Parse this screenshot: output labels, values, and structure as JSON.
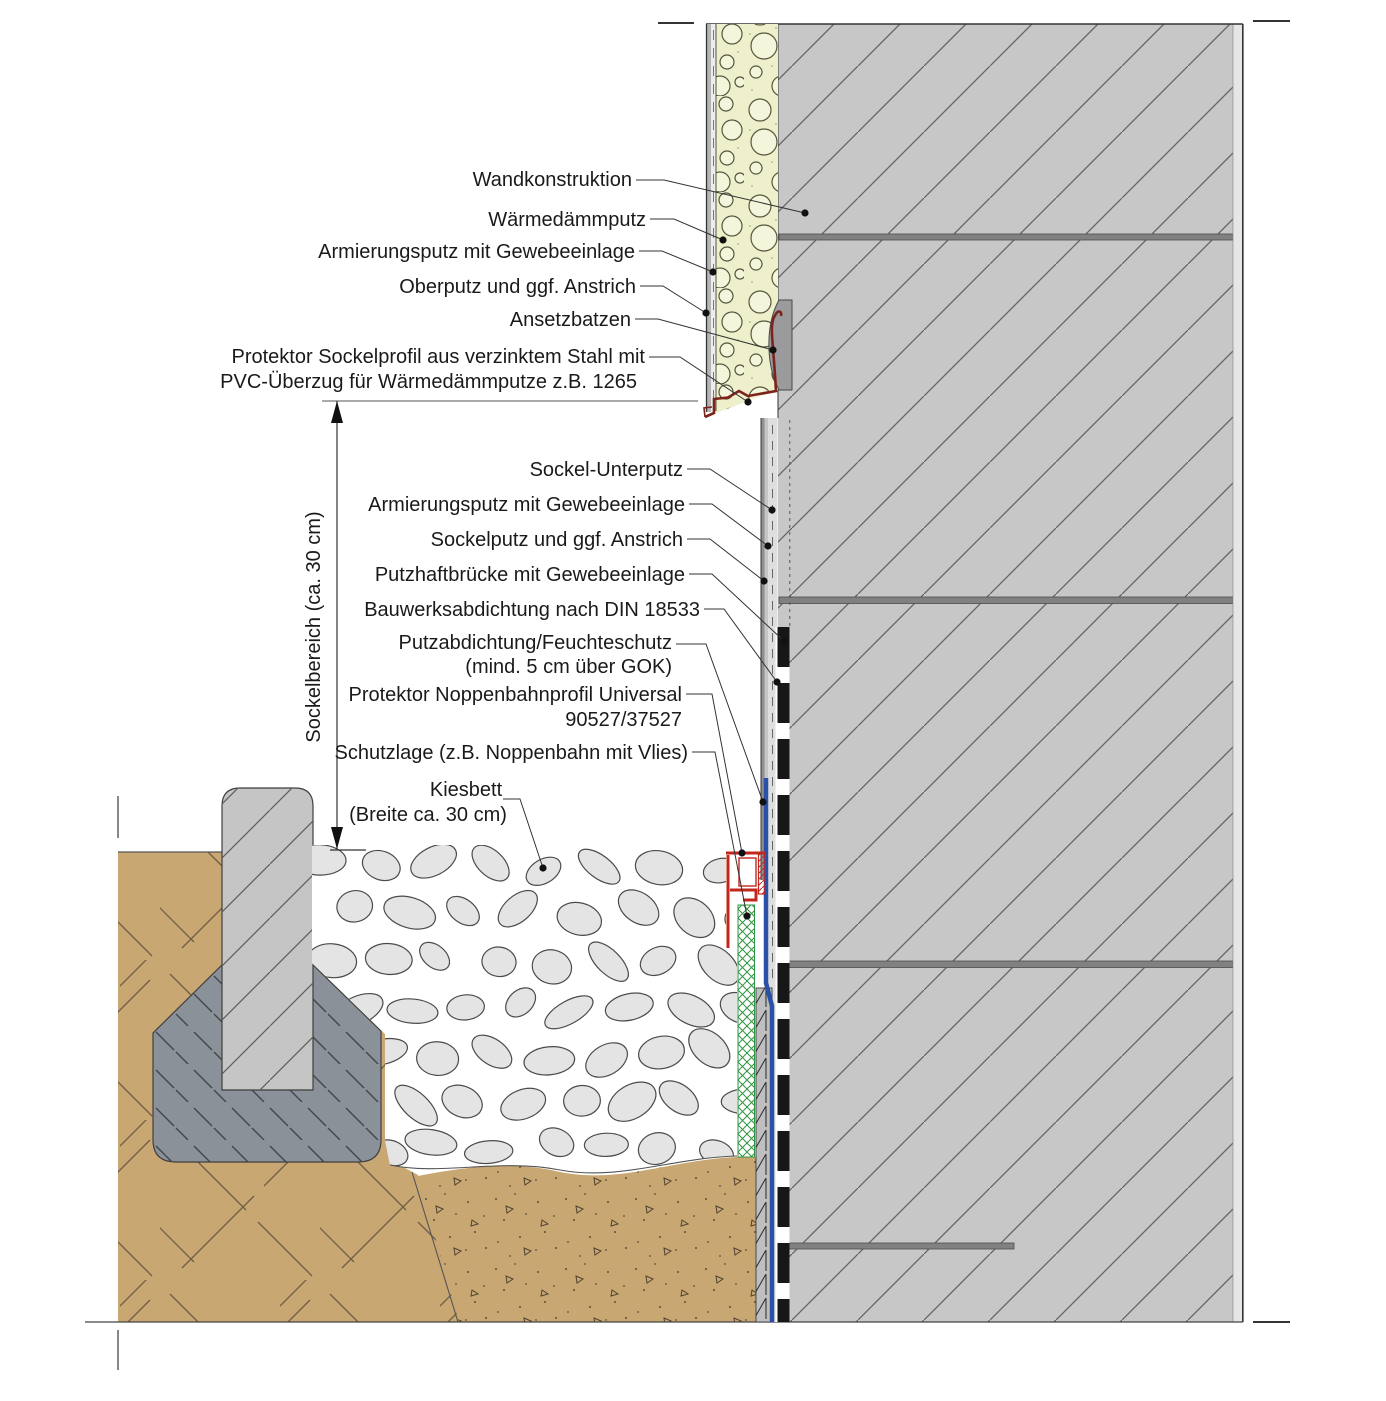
{
  "diagram": {
    "kind": "construction-detail-drawing",
    "labels": {
      "wandkonstruktion": "Wandkonstruktion",
      "waermedaemmputz": "Wärmedämmputz",
      "armierungsputz_oben": "Armierungsputz mit Gewebeeinlage",
      "oberputz": "Oberputz und ggf. Anstrich",
      "ansetzbatzen": "Ansetzbatzen",
      "sockelprofil_line1": "Protektor Sockelprofil aus verzinktem Stahl mit",
      "sockelprofil_line2": "PVC-Überzug für Wärmedämmputze z.B. 1265",
      "sockel_unterputz": "Sockel-Unterputz",
      "armierungsputz_unten": "Armierungsputz mit Gewebeeinlage",
      "sockelputz": "Sockelputz und ggf. Anstrich",
      "putzhaftbruecke": "Putzhaftbrücke mit Gewebeeinlage",
      "bauwerksabdichtung": "Bauwerksabdichtung nach DIN 18533",
      "putzabdichtung_line1": "Putzabdichtung/Feuchteschutz",
      "putzabdichtung_line2": "(mind. 5 cm über GOK)",
      "noppenbahnprofil_line1": "Protektor Noppenbahnprofil Universal",
      "noppenbahnprofil_line2": "90527/37527",
      "schutzlage": "Schutzlage (z.B. Noppenbahn mit Vlies)",
      "kiesbett_line1": "Kiesbett",
      "kiesbett_line2": "(Breite ca. 30 cm)",
      "sockelbereich_dim": "Sockelbereich (ca. 30 cm)"
    },
    "colors": {
      "wall_fill": "#c7c7c7",
      "wall_hatch": "#646464",
      "joint_band": "#818181",
      "insulation_fill": "#eef0cb",
      "soil_fill": "#c9a772",
      "lean_concrete_fill": "#8b9199",
      "kerb_fill": "#c5c5c5",
      "gravel_stone_fill": "#e4e4e4",
      "profile_dark_red": "#7c231d",
      "profile_bright_red": "#c3271c",
      "membrane_blue": "#2a50a8",
      "protection_green": "#2f9441",
      "sealing_black": "#171717"
    }
  }
}
